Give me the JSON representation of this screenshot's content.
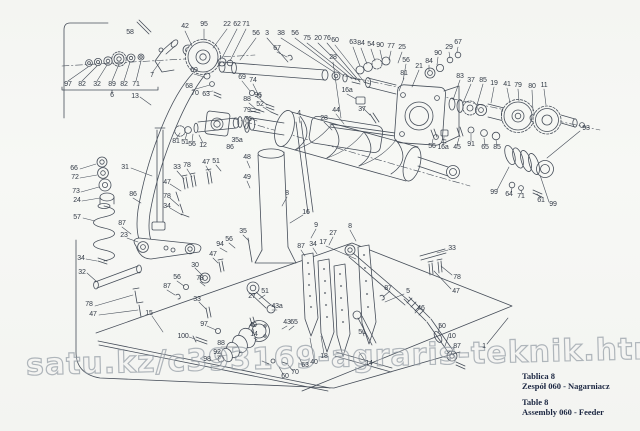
{
  "watermark": {
    "text": "satu.kz/c393169-agraris-teknik.html"
  },
  "caption": {
    "pl_title": "Tablica 8",
    "pl_line": "Zespół 060 - Nagarniacz",
    "en_title": "Table 8",
    "en_line": "Assembly 060 - Feeder"
  },
  "colors": {
    "ink": "#3d4551",
    "paper": "#f6f7f4",
    "caption_text": "#1c2742",
    "watermark": "#9aa3ab",
    "label_text": "#333b47"
  },
  "diagram": {
    "type": "exploded-parts-drawing",
    "part_labels": [
      {
        "n": "58",
        "x": 130,
        "y": 33
      },
      {
        "n": "7",
        "x": 152,
        "y": 76
      },
      {
        "n": "42",
        "x": 185,
        "y": 27
      },
      {
        "n": "95",
        "x": 204,
        "y": 25
      },
      {
        "n": "22",
        "x": 227,
        "y": 25
      },
      {
        "n": "62",
        "x": 237,
        "y": 25
      },
      {
        "n": "71",
        "x": 246,
        "y": 25
      },
      {
        "n": "56",
        "x": 256,
        "y": 34
      },
      {
        "n": "3",
        "x": 267,
        "y": 34
      },
      {
        "n": "38",
        "x": 281,
        "y": 34
      },
      {
        "n": "56",
        "x": 295,
        "y": 34
      },
      {
        "n": "75",
        "x": 307,
        "y": 39
      },
      {
        "n": "20",
        "x": 318,
        "y": 39
      },
      {
        "n": "76",
        "x": 327,
        "y": 39
      },
      {
        "n": "60",
        "x": 335,
        "y": 41
      },
      {
        "n": "67",
        "x": 277,
        "y": 49
      },
      {
        "n": "28",
        "x": 333,
        "y": 58
      },
      {
        "n": "63",
        "x": 353,
        "y": 43
      },
      {
        "n": "84",
        "x": 361,
        "y": 44
      },
      {
        "n": "54",
        "x": 371,
        "y": 45
      },
      {
        "n": "90",
        "x": 380,
        "y": 46
      },
      {
        "n": "77",
        "x": 391,
        "y": 47
      },
      {
        "n": "25",
        "x": 402,
        "y": 48
      },
      {
        "n": "29",
        "x": 449,
        "y": 48
      },
      {
        "n": "67",
        "x": 458,
        "y": 43
      },
      {
        "n": "90",
        "x": 438,
        "y": 54
      },
      {
        "n": "84",
        "x": 429,
        "y": 62
      },
      {
        "n": "21",
        "x": 419,
        "y": 67
      },
      {
        "n": "56",
        "x": 406,
        "y": 61
      },
      {
        "n": "81",
        "x": 404,
        "y": 74
      },
      {
        "n": "83",
        "x": 460,
        "y": 77
      },
      {
        "n": "37",
        "x": 471,
        "y": 81
      },
      {
        "n": "85",
        "x": 483,
        "y": 81
      },
      {
        "n": "19",
        "x": 494,
        "y": 84
      },
      {
        "n": "41",
        "x": 507,
        "y": 85
      },
      {
        "n": "79",
        "x": 518,
        "y": 86
      },
      {
        "n": "80",
        "x": 532,
        "y": 87
      },
      {
        "n": "11",
        "x": 544,
        "y": 86
      },
      {
        "n": "97",
        "x": 68,
        "y": 85
      },
      {
        "n": "82",
        "x": 82,
        "y": 85
      },
      {
        "n": "32",
        "x": 97,
        "y": 85
      },
      {
        "n": "89",
        "x": 112,
        "y": 85
      },
      {
        "n": "82",
        "x": 124,
        "y": 85
      },
      {
        "n": "71",
        "x": 136,
        "y": 85
      },
      {
        "n": "6",
        "x": 112,
        "y": 96
      },
      {
        "n": "13",
        "x": 135,
        "y": 97
      },
      {
        "n": "69",
        "x": 194,
        "y": 71
      },
      {
        "n": "68",
        "x": 189,
        "y": 87
      },
      {
        "n": "70",
        "x": 195,
        "y": 94
      },
      {
        "n": "63",
        "x": 206,
        "y": 95
      },
      {
        "n": "69",
        "x": 242,
        "y": 78
      },
      {
        "n": "74",
        "x": 253,
        "y": 81
      },
      {
        "n": "96",
        "x": 258,
        "y": 96
      },
      {
        "n": "88",
        "x": 247,
        "y": 100
      },
      {
        "n": "52",
        "x": 260,
        "y": 105
      },
      {
        "n": "79",
        "x": 247,
        "y": 111
      },
      {
        "n": "76",
        "x": 248,
        "y": 120
      },
      {
        "n": "4",
        "x": 299,
        "y": 114
      },
      {
        "n": "44",
        "x": 336,
        "y": 111
      },
      {
        "n": "28",
        "x": 324,
        "y": 119
      },
      {
        "n": "16a",
        "x": 347,
        "y": 91
      },
      {
        "n": "37",
        "x": 362,
        "y": 110
      },
      {
        "n": "56",
        "x": 432,
        "y": 147
      },
      {
        "n": "16a",
        "x": 443,
        "y": 148
      },
      {
        "n": "45",
        "x": 457,
        "y": 148
      },
      {
        "n": "91",
        "x": 471,
        "y": 145
      },
      {
        "n": "65",
        "x": 485,
        "y": 148
      },
      {
        "n": "85",
        "x": 497,
        "y": 148
      },
      {
        "n": "93",
        "x": 586,
        "y": 129
      },
      {
        "n": "99",
        "x": 494,
        "y": 193
      },
      {
        "n": "64",
        "x": 509,
        "y": 195
      },
      {
        "n": "71",
        "x": 521,
        "y": 197
      },
      {
        "n": "61",
        "x": 541,
        "y": 201
      },
      {
        "n": "99",
        "x": 553,
        "y": 205
      },
      {
        "n": "81",
        "x": 176,
        "y": 142
      },
      {
        "n": "51",
        "x": 185,
        "y": 143
      },
      {
        "n": "56",
        "x": 192,
        "y": 145
      },
      {
        "n": "12",
        "x": 203,
        "y": 146
      },
      {
        "n": "35a",
        "x": 237,
        "y": 141
      },
      {
        "n": "86",
        "x": 230,
        "y": 148
      },
      {
        "n": "66",
        "x": 74,
        "y": 169
      },
      {
        "n": "72",
        "x": 75,
        "y": 178
      },
      {
        "n": "73",
        "x": 76,
        "y": 192
      },
      {
        "n": "24",
        "x": 77,
        "y": 201
      },
      {
        "n": "57",
        "x": 77,
        "y": 218
      },
      {
        "n": "31",
        "x": 125,
        "y": 168
      },
      {
        "n": "33",
        "x": 177,
        "y": 168
      },
      {
        "n": "78",
        "x": 187,
        "y": 166
      },
      {
        "n": "47",
        "x": 206,
        "y": 163
      },
      {
        "n": "47",
        "x": 167,
        "y": 183
      },
      {
        "n": "78",
        "x": 167,
        "y": 197
      },
      {
        "n": "34",
        "x": 167,
        "y": 207
      },
      {
        "n": "86",
        "x": 133,
        "y": 195
      },
      {
        "n": "51",
        "x": 216,
        "y": 162
      },
      {
        "n": "48",
        "x": 247,
        "y": 158
      },
      {
        "n": "49",
        "x": 247,
        "y": 178
      },
      {
        "n": "8",
        "x": 287,
        "y": 194
      },
      {
        "n": "16",
        "x": 306,
        "y": 213
      },
      {
        "n": "9",
        "x": 316,
        "y": 226
      },
      {
        "n": "27",
        "x": 333,
        "y": 234
      },
      {
        "n": "8",
        "x": 350,
        "y": 227
      },
      {
        "n": "35",
        "x": 243,
        "y": 232
      },
      {
        "n": "87",
        "x": 122,
        "y": 224
      },
      {
        "n": "23",
        "x": 124,
        "y": 236
      },
      {
        "n": "34",
        "x": 81,
        "y": 259
      },
      {
        "n": "32",
        "x": 82,
        "y": 273
      },
      {
        "n": "78",
        "x": 89,
        "y": 305
      },
      {
        "n": "47",
        "x": 93,
        "y": 315
      },
      {
        "n": "15",
        "x": 149,
        "y": 314
      },
      {
        "n": "87",
        "x": 167,
        "y": 287
      },
      {
        "n": "56",
        "x": 177,
        "y": 278
      },
      {
        "n": "30",
        "x": 195,
        "y": 266
      },
      {
        "n": "47",
        "x": 213,
        "y": 255
      },
      {
        "n": "78",
        "x": 200,
        "y": 279
      },
      {
        "n": "33",
        "x": 197,
        "y": 300
      },
      {
        "n": "97",
        "x": 204,
        "y": 325
      },
      {
        "n": "100",
        "x": 183,
        "y": 337
      },
      {
        "n": "94",
        "x": 220,
        "y": 245
      },
      {
        "n": "56",
        "x": 229,
        "y": 240
      },
      {
        "n": "87",
        "x": 301,
        "y": 247
      },
      {
        "n": "34",
        "x": 313,
        "y": 245
      },
      {
        "n": "17",
        "x": 323,
        "y": 243
      },
      {
        "n": "51",
        "x": 265,
        "y": 292
      },
      {
        "n": "27",
        "x": 252,
        "y": 297
      },
      {
        "n": "43a",
        "x": 277,
        "y": 307
      },
      {
        "n": "43",
        "x": 287,
        "y": 323
      },
      {
        "n": "65",
        "x": 294,
        "y": 323
      },
      {
        "n": "49",
        "x": 253,
        "y": 326
      },
      {
        "n": "14",
        "x": 254,
        "y": 335
      },
      {
        "n": "88",
        "x": 221,
        "y": 344
      },
      {
        "n": "92",
        "x": 217,
        "y": 353
      },
      {
        "n": "98",
        "x": 207,
        "y": 360
      },
      {
        "n": "60",
        "x": 285,
        "y": 377
      },
      {
        "n": "70",
        "x": 295,
        "y": 373
      },
      {
        "n": "63",
        "x": 305,
        "y": 366
      },
      {
        "n": "40",
        "x": 314,
        "y": 363
      },
      {
        "n": "18",
        "x": 324,
        "y": 357
      },
      {
        "n": "14",
        "x": 369,
        "y": 364
      },
      {
        "n": "33",
        "x": 452,
        "y": 249
      },
      {
        "n": "78",
        "x": 457,
        "y": 278
      },
      {
        "n": "47",
        "x": 456,
        "y": 292
      },
      {
        "n": "87",
        "x": 388,
        "y": 289
      },
      {
        "n": "5",
        "x": 408,
        "y": 292
      },
      {
        "n": "51",
        "x": 362,
        "y": 333
      },
      {
        "n": "46",
        "x": 421,
        "y": 309
      },
      {
        "n": "50",
        "x": 442,
        "y": 327
      },
      {
        "n": "10",
        "x": 452,
        "y": 337
      },
      {
        "n": "87",
        "x": 457,
        "y": 347
      },
      {
        "n": "1",
        "x": 484,
        "y": 347
      }
    ]
  }
}
